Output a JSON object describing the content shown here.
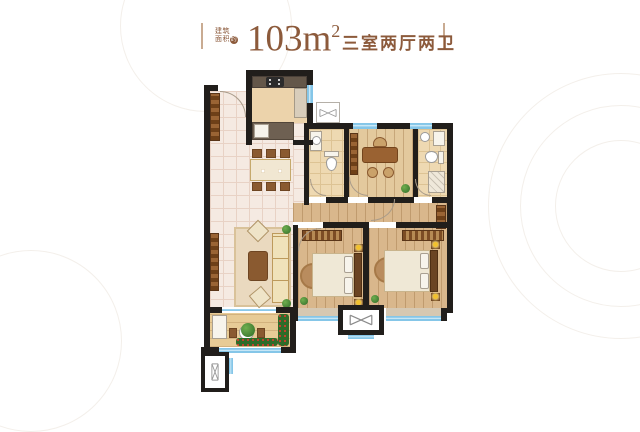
{
  "header": {
    "area_note_line1": "建筑",
    "area_note_line2": "面积",
    "area_note_badge": "约",
    "area_value": "103m",
    "area_superscript": "2",
    "layout_label": "三室两厅两卫"
  },
  "colors": {
    "accent_text": "#8c5a3b",
    "divider_bar": "#c9ab92",
    "wall": "#211e1b",
    "window_glass": "#85c6e8",
    "hall_tile_floor": "#f5eae2",
    "bedroom_wood_floor": "#d9b78c",
    "kitchen_floor": "#ecd3ab",
    "bathroom_floor": "#eed9b2",
    "balcony_floor": "#e7cb96",
    "furniture_wood": "#8a5a30",
    "upholstery": "#f0e2ba",
    "plant_green": "#3f7d33",
    "flower_red": "#c0392b",
    "lamp_yellow": "#f2c12e"
  },
  "icons": {
    "flue_symbol": "bowtie-duct-icon",
    "shaft_symbol": "vertical-duct-icon",
    "door_symbol": "quarter-arc-door-swing"
  }
}
